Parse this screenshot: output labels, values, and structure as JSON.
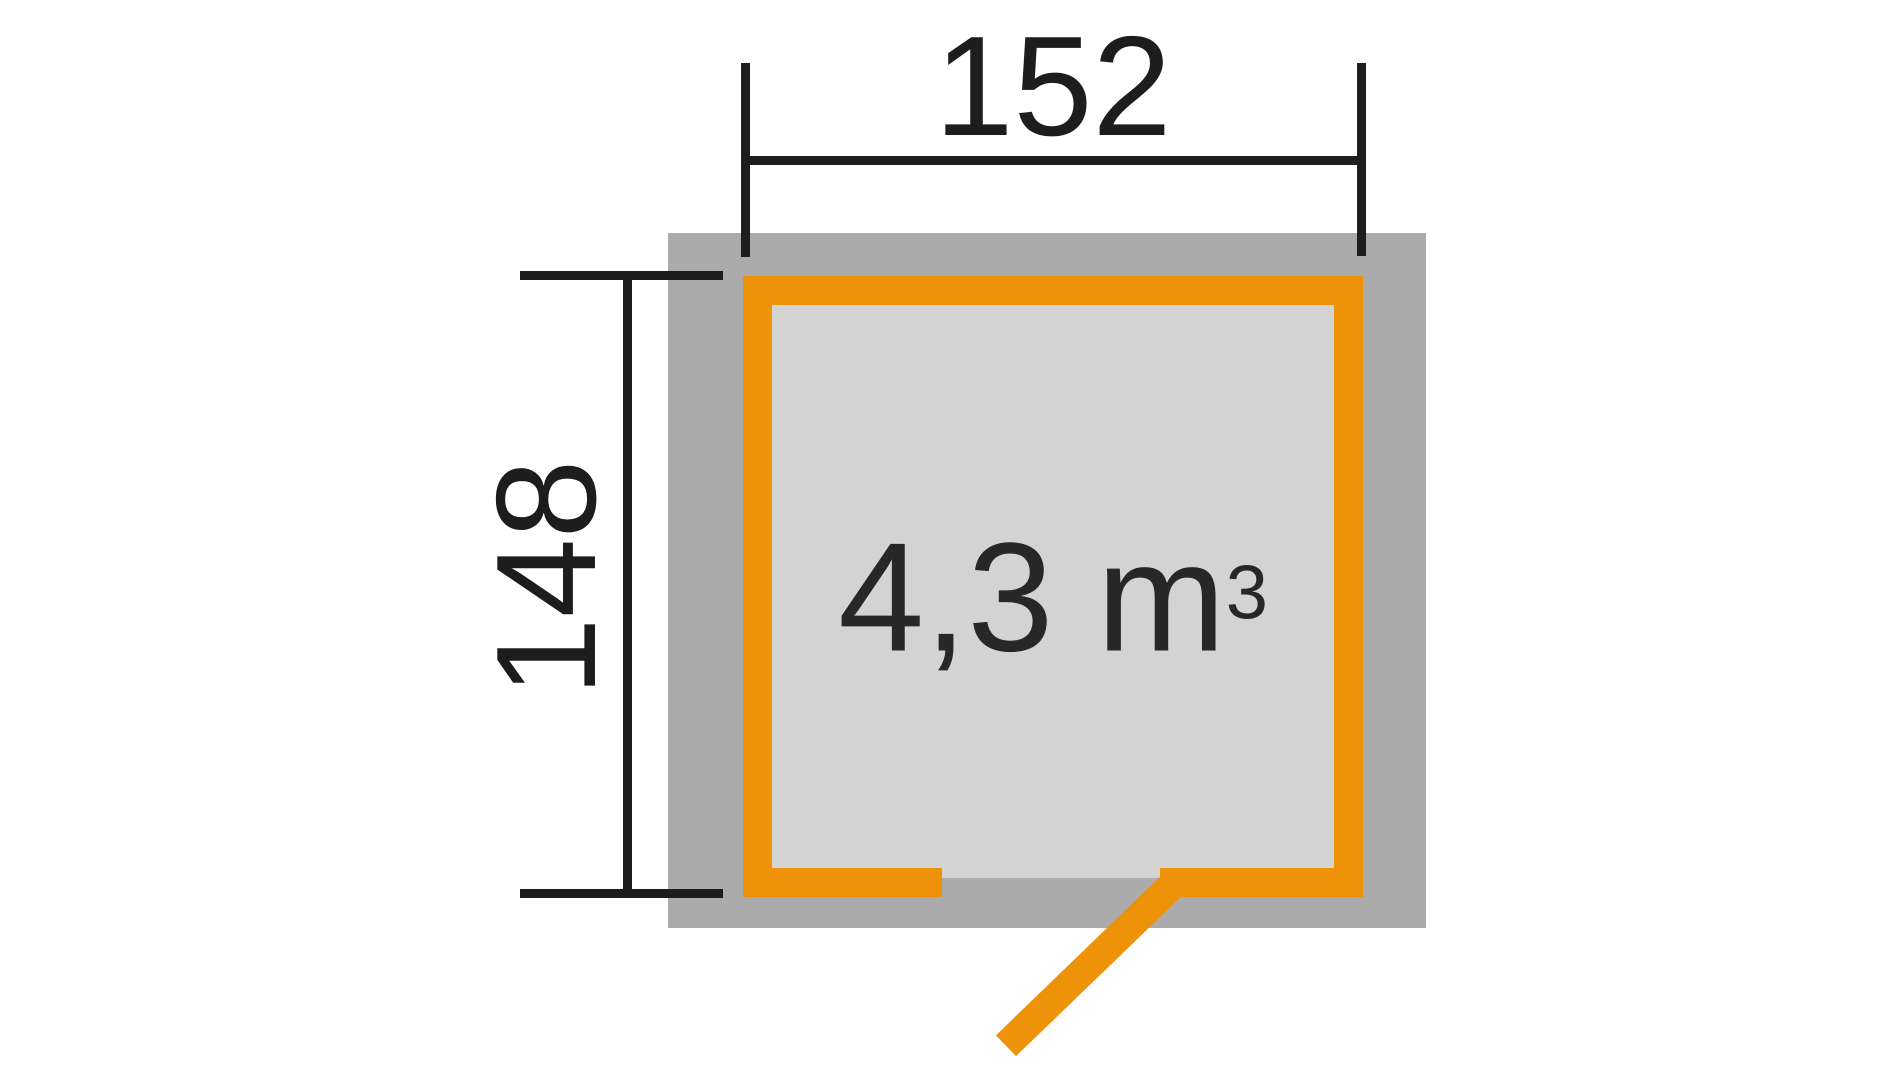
{
  "floor_plan": {
    "width_dimension_label": "152",
    "height_dimension_label": "148",
    "volume_label": {
      "base": "4,3 m",
      "exponent": "3"
    },
    "colors": {
      "wall_orange": "#ee9209",
      "foundation_gray": "#ababab",
      "floor_gray": "#d3d3d3",
      "dimension_black": "#1d1d1b",
      "background": "#ffffff"
    }
  }
}
